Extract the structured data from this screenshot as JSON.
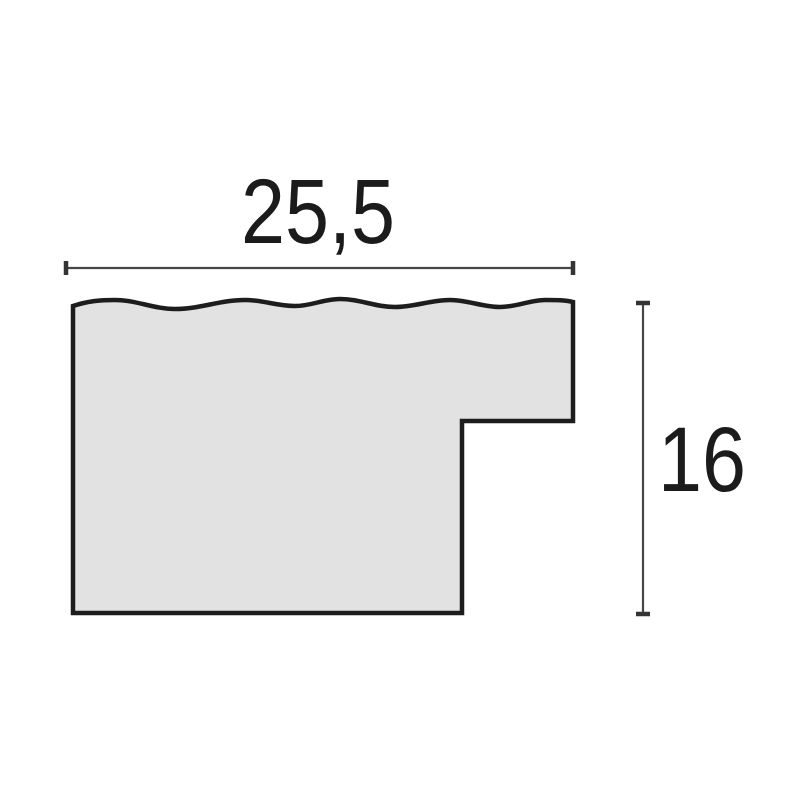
{
  "diagram": {
    "dimensions": {
      "width": {
        "label": "25,5"
      },
      "height": {
        "label": "16"
      }
    },
    "colors": {
      "background": "#ffffff",
      "profile_fill": "#e2e2e2",
      "profile_outline": "#1d1d1d",
      "dimension_line": "#474747",
      "label_text": "#1b1b1b"
    }
  }
}
